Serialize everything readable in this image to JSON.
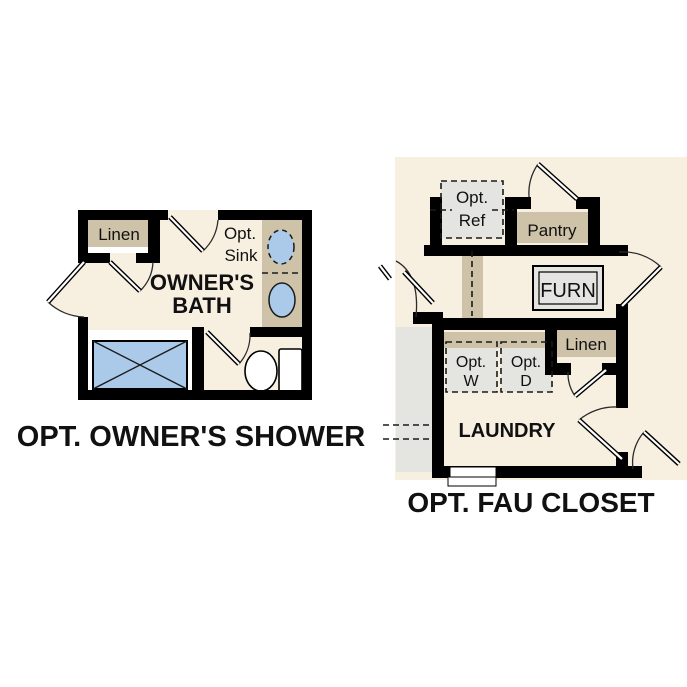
{
  "colors": {
    "floor": "#f7f0e1",
    "cabinet_tan": "#cec3a8",
    "fixture_gray": "#e4e4e0",
    "water_blue": "#abc9e8",
    "wall_black": "#000000",
    "text_black": "#111111",
    "background_white": "#ffffff"
  },
  "left_plan": {
    "title": "OPT. OWNER'S SHOWER",
    "linen_label": "Linen",
    "opt_sink_line1": "Opt.",
    "opt_sink_line2": "Sink",
    "room_line1": "OWNER'S",
    "room_line2": "BATH"
  },
  "right_plan": {
    "title": "OPT. FAU CLOSET",
    "opt_ref_line1": "Opt.",
    "opt_ref_line2": "Ref",
    "pantry_label": "Pantry",
    "furn_label": "FURN",
    "linen_label": "Linen",
    "opt_w_line1": "Opt.",
    "opt_w_line2": "W",
    "opt_d_line1": "Opt.",
    "opt_d_line2": "D",
    "laundry_label": "LAUNDRY"
  }
}
